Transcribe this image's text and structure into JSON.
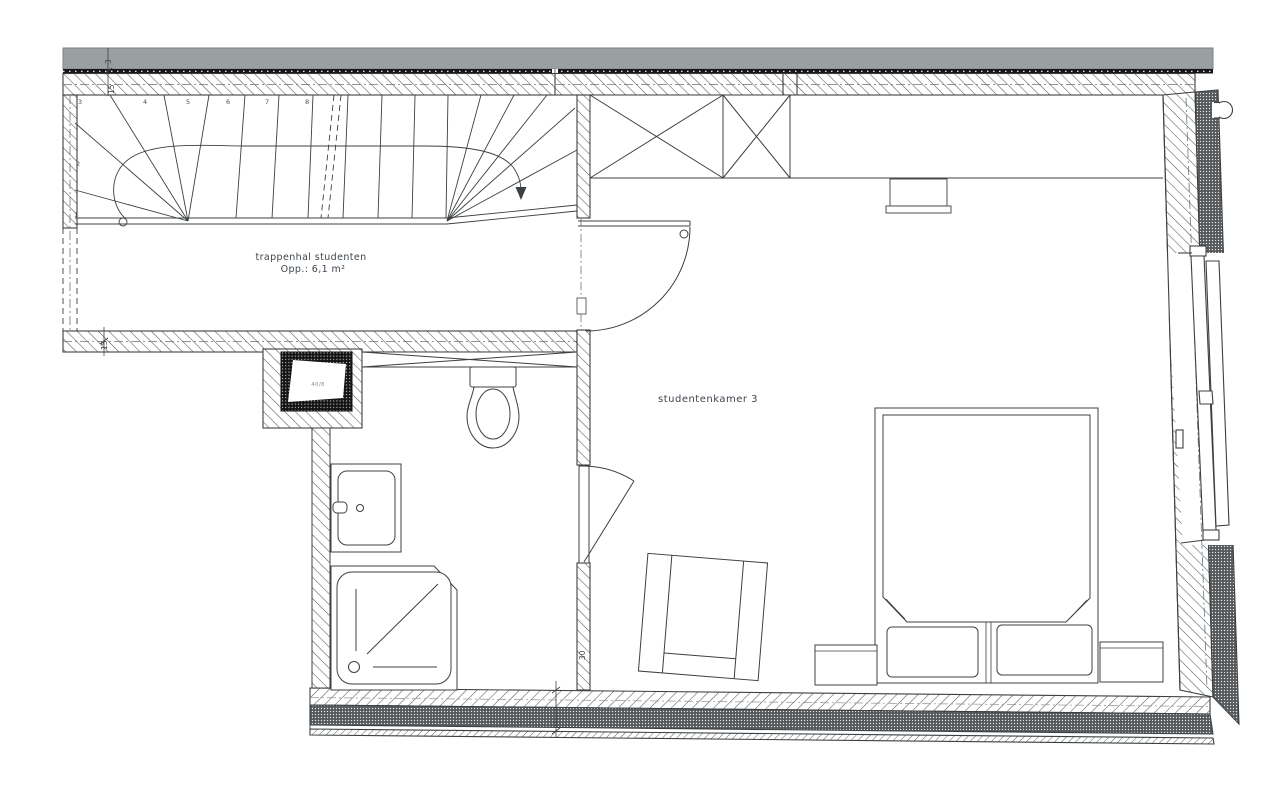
{
  "drawing": {
    "stair_hall": {
      "label": "trappenhal studenten",
      "area": "Opp.: 6,1 m²"
    },
    "student_room": {
      "label": "studentenkamer 3"
    },
    "flue": {
      "label": "40/8"
    },
    "dimensions": {
      "top_a": "3",
      "top_b": "15",
      "hall_bottom": "15",
      "bath_wall": "30"
    },
    "stair_numbers": [
      "1",
      "2",
      "3",
      "4",
      "5",
      "6",
      "7",
      "8"
    ]
  },
  "colors": {
    "facade_band": "#9aa0a2",
    "band_edge": "#161616",
    "wall_line": "#3c4043",
    "hatch_line": "#54585a",
    "stipple_fill": "#63676a",
    "centerline": "#6e7375",
    "text": "#3d454c"
  }
}
